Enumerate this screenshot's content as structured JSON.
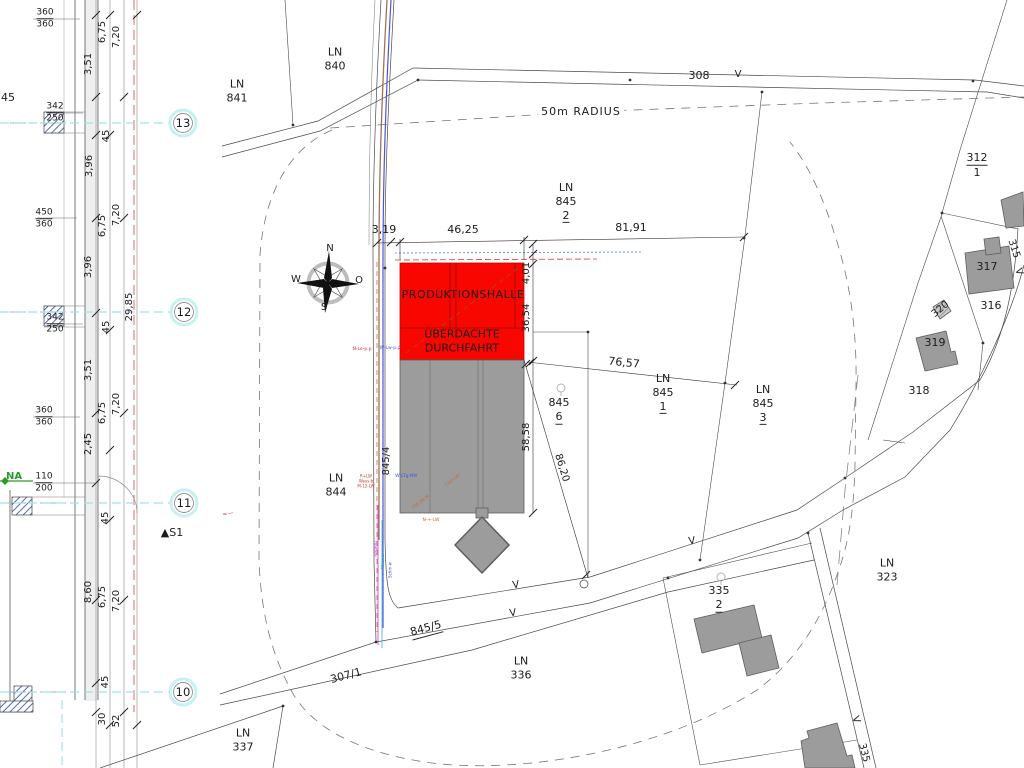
{
  "drawing": {
    "type": "site-plan",
    "main_building_label": "PRODUKTIONSHALLE",
    "radius_note": "50m RADIUS"
  },
  "colors": {
    "production_hall_red": "#f80600",
    "building_gray": "#9c9c9c",
    "grid_cyan": "#aee8ea",
    "axis_red": "#e05555",
    "hatch_blue": "#3d57a6",
    "utility_blue": "#4a55d8",
    "utility_brown": "#a3714e",
    "green": "#2a9b2a",
    "magenta": "#c23ac2",
    "orange": "#c66a28"
  },
  "labels": [
    {
      "name": "label-ln-841",
      "x": 237,
      "y": 91,
      "lines": [
        {
          "t": "LN",
          "row": 1
        },
        {
          "t": "841",
          "row": 1
        }
      ]
    },
    {
      "name": "label-ln-840",
      "x": 335,
      "y": 59,
      "lines": [
        {
          "t": "LN",
          "row": 1
        },
        {
          "t": "840",
          "row": 1
        }
      ]
    },
    {
      "name": "label-50m-radius",
      "x": 581,
      "y": 112,
      "bg": true,
      "ls": 1,
      "lines": [
        {
          "t": "50m RADIUS",
          "row": 1
        }
      ]
    },
    {
      "name": "label-road-308",
      "x": 699,
      "y": 76,
      "lines": [
        {
          "t": "308",
          "row": 1
        }
      ]
    },
    {
      "name": "marker-v-308",
      "x": 738,
      "y": 75,
      "size": 10,
      "lines": [
        {
          "t": "V",
          "row": 1
        }
      ]
    },
    {
      "name": "label-ln-845-2",
      "x": 566,
      "y": 202,
      "lines": [
        {
          "t": "LN",
          "row": 1
        },
        {
          "t": "845",
          "row": 1
        },
        {
          "t": "2",
          "row": 1,
          "u": true
        }
      ]
    },
    {
      "name": "dim-81-91",
      "x": 631,
      "y": 228,
      "lines": [
        {
          "t": "81,91",
          "row": 1
        }
      ]
    },
    {
      "name": "dim-3-19",
      "x": 384,
      "y": 230,
      "lines": [
        {
          "t": "3,19",
          "row": 1
        }
      ]
    },
    {
      "name": "dim-46-25",
      "x": 463,
      "y": 230,
      "lines": [
        {
          "t": "46,25",
          "row": 1
        }
      ]
    },
    {
      "name": "dim-4-01",
      "x": 527,
      "y": 273,
      "rot": -90,
      "size": 10,
      "lines": [
        {
          "t": "4,01",
          "row": 1
        }
      ]
    },
    {
      "name": "dim-36-54",
      "x": 527,
      "y": 318,
      "rot": -90,
      "size": 10,
      "lines": [
        {
          "t": "36,54",
          "row": 1
        }
      ]
    },
    {
      "name": "dim-58-58",
      "x": 527,
      "y": 437,
      "rot": -90,
      "size": 10,
      "lines": [
        {
          "t": "58,58",
          "row": 1
        }
      ]
    },
    {
      "name": "dim-86-20",
      "x": 561,
      "y": 468,
      "rot": 73,
      "size": 10,
      "lines": [
        {
          "t": "86,20",
          "row": 1
        }
      ]
    },
    {
      "name": "dim-76-57",
      "x": 624,
      "y": 363,
      "rot": 6,
      "lines": [
        {
          "t": "76,57",
          "row": 1
        }
      ]
    },
    {
      "name": "label-ln-845-1",
      "x": 663,
      "y": 393,
      "lines": [
        {
          "t": "LN",
          "row": 1
        },
        {
          "t": "845",
          "row": 1
        },
        {
          "t": "1",
          "row": 1,
          "u": true
        }
      ]
    },
    {
      "name": "label-ln-845-3",
      "x": 763,
      "y": 404,
      "lines": [
        {
          "t": "LN",
          "row": 1
        },
        {
          "t": "845",
          "row": 1
        },
        {
          "t": "3",
          "row": 1,
          "u": true
        }
      ]
    },
    {
      "name": "label-845-6",
      "x": 559,
      "y": 410,
      "lines": [
        {
          "t": "845",
          "row": 1
        },
        {
          "t": "6",
          "row": 1,
          "u": true
        }
      ]
    },
    {
      "name": "label-ln-844",
      "x": 336,
      "y": 485,
      "lines": [
        {
          "t": "LN",
          "row": 1
        },
        {
          "t": "844",
          "row": 1
        }
      ]
    },
    {
      "name": "label-produktionshalle",
      "x": 463,
      "y": 295,
      "ls": 0.5,
      "lines": [
        {
          "t": "PRODUKTIONSHALLE",
          "row": 1
        }
      ]
    },
    {
      "name": "label-ueberdachte-durchfahrt",
      "x": 462,
      "y": 341,
      "lines": [
        {
          "t": "ÜBERDACHTE",
          "row": 1
        },
        {
          "t": "DURCHFAHRT",
          "row": 1
        }
      ]
    },
    {
      "name": "label-845-4",
      "x": 387,
      "y": 461,
      "rot": -90,
      "size": 10,
      "lines": [
        {
          "t": "845/4",
          "row": 1
        }
      ]
    },
    {
      "name": "label-845-5",
      "x": 426,
      "y": 629,
      "rot": -15,
      "lines": [
        {
          "t": "845/5",
          "row": 1,
          "u": true
        }
      ]
    },
    {
      "name": "label-307-1",
      "x": 346,
      "y": 676,
      "rot": -15,
      "lines": [
        {
          "t": "307/1",
          "row": 1
        }
      ]
    },
    {
      "name": "label-ln-336",
      "x": 521,
      "y": 668,
      "lines": [
        {
          "t": "LN",
          "row": 1
        },
        {
          "t": "336",
          "row": 1
        }
      ]
    },
    {
      "name": "label-ln-337",
      "x": 243,
      "y": 740,
      "lines": [
        {
          "t": "LN",
          "row": 1
        },
        {
          "t": "337",
          "row": 1
        }
      ]
    },
    {
      "name": "label-ln-323",
      "x": 887,
      "y": 570,
      "lines": [
        {
          "t": "LN",
          "row": 1
        },
        {
          "t": "323",
          "row": 1
        }
      ]
    },
    {
      "name": "label-335-2",
      "x": 719,
      "y": 598,
      "lines": [
        {
          "t": "335",
          "row": 1
        },
        {
          "t": "2",
          "row": 1,
          "u": true
        }
      ]
    },
    {
      "name": "marker-v-1",
      "x": 516,
      "y": 586,
      "size": 10,
      "rot": -8,
      "lines": [
        {
          "t": "V",
          "row": 1
        }
      ]
    },
    {
      "name": "marker-v-2",
      "x": 513,
      "y": 614,
      "size": 10,
      "rot": -8,
      "lines": [
        {
          "t": "V",
          "row": 1
        }
      ]
    },
    {
      "name": "marker-v-3",
      "x": 692,
      "y": 542,
      "size": 10,
      "rot": -8,
      "lines": [
        {
          "t": "V",
          "row": 1
        }
      ]
    },
    {
      "name": "marker-v-4",
      "x": 855,
      "y": 720,
      "size": 10,
      "rot": 70,
      "lines": [
        {
          "t": "V",
          "row": 1
        }
      ]
    },
    {
      "name": "label-road-335",
      "x": 863,
      "y": 753,
      "size": 10,
      "rot": 76,
      "lines": [
        {
          "t": "335",
          "row": 1
        }
      ]
    },
    {
      "name": "label-road-315",
      "x": 1013,
      "y": 249,
      "size": 10,
      "rot": 72,
      "lines": [
        {
          "t": "315",
          "row": 1
        }
      ]
    },
    {
      "name": "marker-v-315",
      "x": 1018,
      "y": 272,
      "size": 10,
      "rot": 72,
      "lines": [
        {
          "t": "V",
          "row": 1
        }
      ]
    },
    {
      "name": "label-312-1",
      "x": 977,
      "y": 165,
      "lines": [
        {
          "t": "312",
          "row": 1,
          "u": true
        },
        {
          "t": "1",
          "row": 1
        }
      ]
    },
    {
      "name": "label-building-317",
      "x": 987,
      "y": 267,
      "lines": [
        {
          "t": "317",
          "row": 1
        }
      ]
    },
    {
      "name": "label-316",
      "x": 991,
      "y": 306,
      "lines": [
        {
          "t": "316",
          "row": 1
        }
      ]
    },
    {
      "name": "label-building-320",
      "x": 941,
      "y": 310,
      "size": 10,
      "rot": -40,
      "lines": [
        {
          "t": "320",
          "row": 1
        }
      ]
    },
    {
      "name": "label-building-319",
      "x": 935,
      "y": 343,
      "lines": [
        {
          "t": "319",
          "row": 1
        }
      ]
    },
    {
      "name": "label-318",
      "x": 919,
      "y": 391,
      "lines": [
        {
          "t": "318",
          "row": 1
        }
      ]
    },
    {
      "name": "marker-s1",
      "x": 172,
      "y": 533,
      "lines": [
        {
          "t": "▲S1",
          "row": 1
        }
      ]
    },
    {
      "name": "grid-label-13",
      "x": 183,
      "y": 123,
      "size": 11.5,
      "lines": [
        {
          "t": "13",
          "row": 1
        }
      ]
    },
    {
      "name": "grid-label-12",
      "x": 184,
      "y": 312,
      "size": 11.5,
      "lines": [
        {
          "t": "12",
          "row": 1
        }
      ]
    },
    {
      "name": "grid-label-11",
      "x": 184,
      "y": 503,
      "size": 11.5,
      "lines": [
        {
          "t": "11",
          "row": 1
        }
      ]
    },
    {
      "name": "grid-label-10",
      "x": 183,
      "y": 692,
      "size": 11.5,
      "lines": [
        {
          "t": "10",
          "row": 1
        }
      ]
    },
    {
      "name": "compass-label-n",
      "x": 330,
      "y": 249,
      "size": 10,
      "lines": [
        {
          "t": "N",
          "row": 1
        }
      ]
    },
    {
      "name": "compass-label-w",
      "x": 296,
      "y": 280,
      "size": 10,
      "lines": [
        {
          "t": "W",
          "row": 1
        }
      ]
    },
    {
      "name": "compass-label-o",
      "x": 359,
      "y": 281,
      "size": 10,
      "lines": [
        {
          "t": "O",
          "row": 1
        }
      ]
    },
    {
      "name": "compass-label-s",
      "x": 324,
      "y": 308,
      "size": 10,
      "lines": [
        {
          "t": "S",
          "row": 1
        }
      ]
    },
    {
      "name": "dim-6-75-a",
      "x": 103,
      "y": 32,
      "rot": -90,
      "size": 10,
      "lines": [
        {
          "t": "6,75",
          "row": 1
        }
      ]
    },
    {
      "name": "dim-7-20-a",
      "x": 117,
      "y": 37,
      "rot": -90,
      "size": 10,
      "lines": [
        {
          "t": "7,20",
          "row": 1
        }
      ]
    },
    {
      "name": "dim-3-51-a",
      "x": 89,
      "y": 64,
      "rot": -90,
      "size": 10,
      "lines": [
        {
          "t": "3,51",
          "row": 1
        }
      ]
    },
    {
      "name": "dim-45-cut",
      "x": 8,
      "y": 98,
      "size": 11,
      "lines": [
        {
          "t": "45",
          "row": 1
        }
      ]
    },
    {
      "name": "dim-45-a",
      "x": 107,
      "y": 136,
      "rot": -90,
      "size": 10,
      "lines": [
        {
          "t": "45",
          "row": 1
        }
      ]
    },
    {
      "name": "dim-3-96-a",
      "x": 90,
      "y": 166,
      "rot": -90,
      "size": 10,
      "lines": [
        {
          "t": "3,96",
          "row": 1
        }
      ]
    },
    {
      "name": "dim-6-75-b",
      "x": 103,
      "y": 226,
      "rot": -90,
      "size": 10,
      "lines": [
        {
          "t": "6,75",
          "row": 1
        }
      ]
    },
    {
      "name": "dim-7-20-b",
      "x": 117,
      "y": 215,
      "rot": -90,
      "size": 10,
      "lines": [
        {
          "t": "7,20",
          "row": 1
        }
      ]
    },
    {
      "name": "dim-3-96-b",
      "x": 89,
      "y": 267,
      "rot": -90,
      "size": 10,
      "lines": [
        {
          "t": "3,96",
          "row": 1
        }
      ]
    },
    {
      "name": "dim-29-85",
      "x": 130,
      "y": 307,
      "rot": -90,
      "size": 10,
      "lines": [
        {
          "t": "29,85",
          "row": 1
        }
      ]
    },
    {
      "name": "dim-45-b",
      "x": 107,
      "y": 327,
      "rot": -90,
      "size": 10,
      "lines": [
        {
          "t": "45",
          "row": 1
        }
      ]
    },
    {
      "name": "dim-3-51-b",
      "x": 89,
      "y": 370,
      "rot": -90,
      "size": 10,
      "lines": [
        {
          "t": "3,51",
          "row": 1
        }
      ]
    },
    {
      "name": "dim-6-75-c",
      "x": 103,
      "y": 413,
      "rot": -90,
      "size": 10,
      "lines": [
        {
          "t": "6,75",
          "row": 1
        }
      ]
    },
    {
      "name": "dim-7-20-c",
      "x": 117,
      "y": 404,
      "rot": -90,
      "size": 10,
      "lines": [
        {
          "t": "7,20",
          "row": 1
        }
      ]
    },
    {
      "name": "dim-2-45",
      "x": 89,
      "y": 444,
      "rot": -90,
      "size": 10,
      "lines": [
        {
          "t": "2,45",
          "row": 1
        }
      ]
    },
    {
      "name": "dim-45-c",
      "x": 106,
      "y": 518,
      "rot": -90,
      "size": 10,
      "lines": [
        {
          "t": "45",
          "row": 1
        }
      ]
    },
    {
      "name": "dim-8-60",
      "x": 89,
      "y": 592,
      "rot": -90,
      "size": 10,
      "lines": [
        {
          "t": "8,60",
          "row": 1
        }
      ]
    },
    {
      "name": "dim-6-75-d",
      "x": 103,
      "y": 597,
      "rot": -90,
      "size": 10,
      "lines": [
        {
          "t": "6,75",
          "row": 1
        }
      ]
    },
    {
      "name": "dim-7-20-d",
      "x": 117,
      "y": 601,
      "rot": -90,
      "size": 10,
      "lines": [
        {
          "t": "7,20",
          "row": 1
        }
      ]
    },
    {
      "name": "dim-45-d",
      "x": 106,
      "y": 682,
      "rot": -90,
      "size": 10,
      "lines": [
        {
          "t": "45",
          "row": 1
        }
      ]
    },
    {
      "name": "dim-30",
      "x": 103,
      "y": 719,
      "rot": -90,
      "size": 10,
      "lines": [
        {
          "t": "30",
          "row": 1
        }
      ]
    },
    {
      "name": "dim-52",
      "x": 117,
      "y": 721,
      "rot": -90,
      "size": 10,
      "lines": [
        {
          "t": "52",
          "row": 1
        }
      ]
    },
    {
      "name": "window-dim-1",
      "x": 45,
      "y": 19,
      "size": 9,
      "lines": [
        {
          "t": "360",
          "row": 1,
          "u": true
        },
        {
          "t": "360",
          "row": 1
        }
      ]
    },
    {
      "name": "window-dim-2",
      "x": 55,
      "y": 113,
      "size": 9,
      "lines": [
        {
          "t": "342",
          "row": 1,
          "u": true
        },
        {
          "t": "250",
          "row": 1
        }
      ]
    },
    {
      "name": "window-dim-3",
      "x": 44,
      "y": 219,
      "size": 9,
      "lines": [
        {
          "t": "450",
          "row": 1,
          "u": true
        },
        {
          "t": "360",
          "row": 1
        }
      ]
    },
    {
      "name": "window-dim-4",
      "x": 55,
      "y": 324,
      "size": 9,
      "lines": [
        {
          "t": "342",
          "row": 1,
          "u": true
        },
        {
          "t": "250",
          "row": 1
        }
      ]
    },
    {
      "name": "window-dim-5",
      "x": 44,
      "y": 417,
      "size": 9,
      "lines": [
        {
          "t": "360",
          "row": 1,
          "u": true
        },
        {
          "t": "360",
          "row": 1
        }
      ]
    },
    {
      "name": "window-dim-6",
      "x": 44,
      "y": 483,
      "size": 9,
      "lines": [
        {
          "t": "110",
          "row": 1,
          "u": true
        },
        {
          "t": "200",
          "row": 1
        }
      ]
    },
    {
      "name": "label-na",
      "x": 14,
      "y": 477,
      "size": 10,
      "color": "#2a9b2a",
      "bold": true,
      "lines": [
        {
          "t": "NA",
          "row": 1
        }
      ]
    },
    {
      "name": "utility-note-1",
      "x": 362,
      "y": 350,
      "size": 4.5,
      "color": "#cc3333",
      "lines": [
        {
          "t": "N-Le-p.p",
          "row": 1
        }
      ]
    },
    {
      "name": "utility-note-2",
      "x": 390,
      "y": 349,
      "size": 4.5,
      "color": "#3b55e0",
      "lines": [
        {
          "t": "W-Lw-p.p",
          "row": 1
        }
      ]
    },
    {
      "name": "utility-note-3",
      "x": 366,
      "y": 481,
      "size": 4,
      "color": "#cc3333",
      "lines": [
        {
          "t": "R+LW",
          "row": 1
        },
        {
          "t": "Wass-b",
          "row": 1
        },
        {
          "t": "M-12-LW",
          "row": 1
        }
      ]
    },
    {
      "name": "utility-note-4",
      "x": 406,
      "y": 477,
      "size": 4.5,
      "color": "#3b55e0",
      "lines": [
        {
          "t": "W-LTg-NN",
          "row": 1
        }
      ]
    },
    {
      "name": "utility-note-5",
      "x": 377,
      "y": 549,
      "size": 4.5,
      "rot": -90,
      "color": "#c23ac2",
      "lines": [
        {
          "t": "Regenl",
          "row": 1
        }
      ]
    },
    {
      "name": "utility-note-6",
      "x": 384,
      "y": 561,
      "size": 4.5,
      "rot": -90,
      "color": "#2ba8c8",
      "lines": [
        {
          "t": "Wasser",
          "row": 1
        }
      ]
    },
    {
      "name": "utility-note-7",
      "x": 390,
      "y": 570,
      "size": 4,
      "rot": -90,
      "color": "#3b55e0",
      "lines": [
        {
          "t": "Schm-w",
          "row": 1
        }
      ]
    },
    {
      "name": "utility-note-8",
      "x": 421,
      "y": 503,
      "size": 4.5,
      "rot": -38,
      "color": "#c66a28",
      "lines": [
        {
          "t": "750,26 M",
          "row": 1
        }
      ]
    },
    {
      "name": "utility-note-9",
      "x": 431,
      "y": 521,
      "size": 4.5,
      "color": "#c66a28",
      "lines": [
        {
          "t": "N-+-LW",
          "row": 1
        }
      ]
    },
    {
      "name": "utility-note-10",
      "x": 452,
      "y": 480,
      "size": 4,
      "rot": -38,
      "color": "#c66a28",
      "lines": [
        {
          "t": "7,50+LW",
          "row": 1
        }
      ]
    },
    {
      "name": "sketch-mark",
      "x": 228,
      "y": 514,
      "size": 6,
      "rot": -10,
      "color": "#b05050",
      "lines": [
        {
          "t": "≈—",
          "row": 1
        }
      ]
    }
  ]
}
